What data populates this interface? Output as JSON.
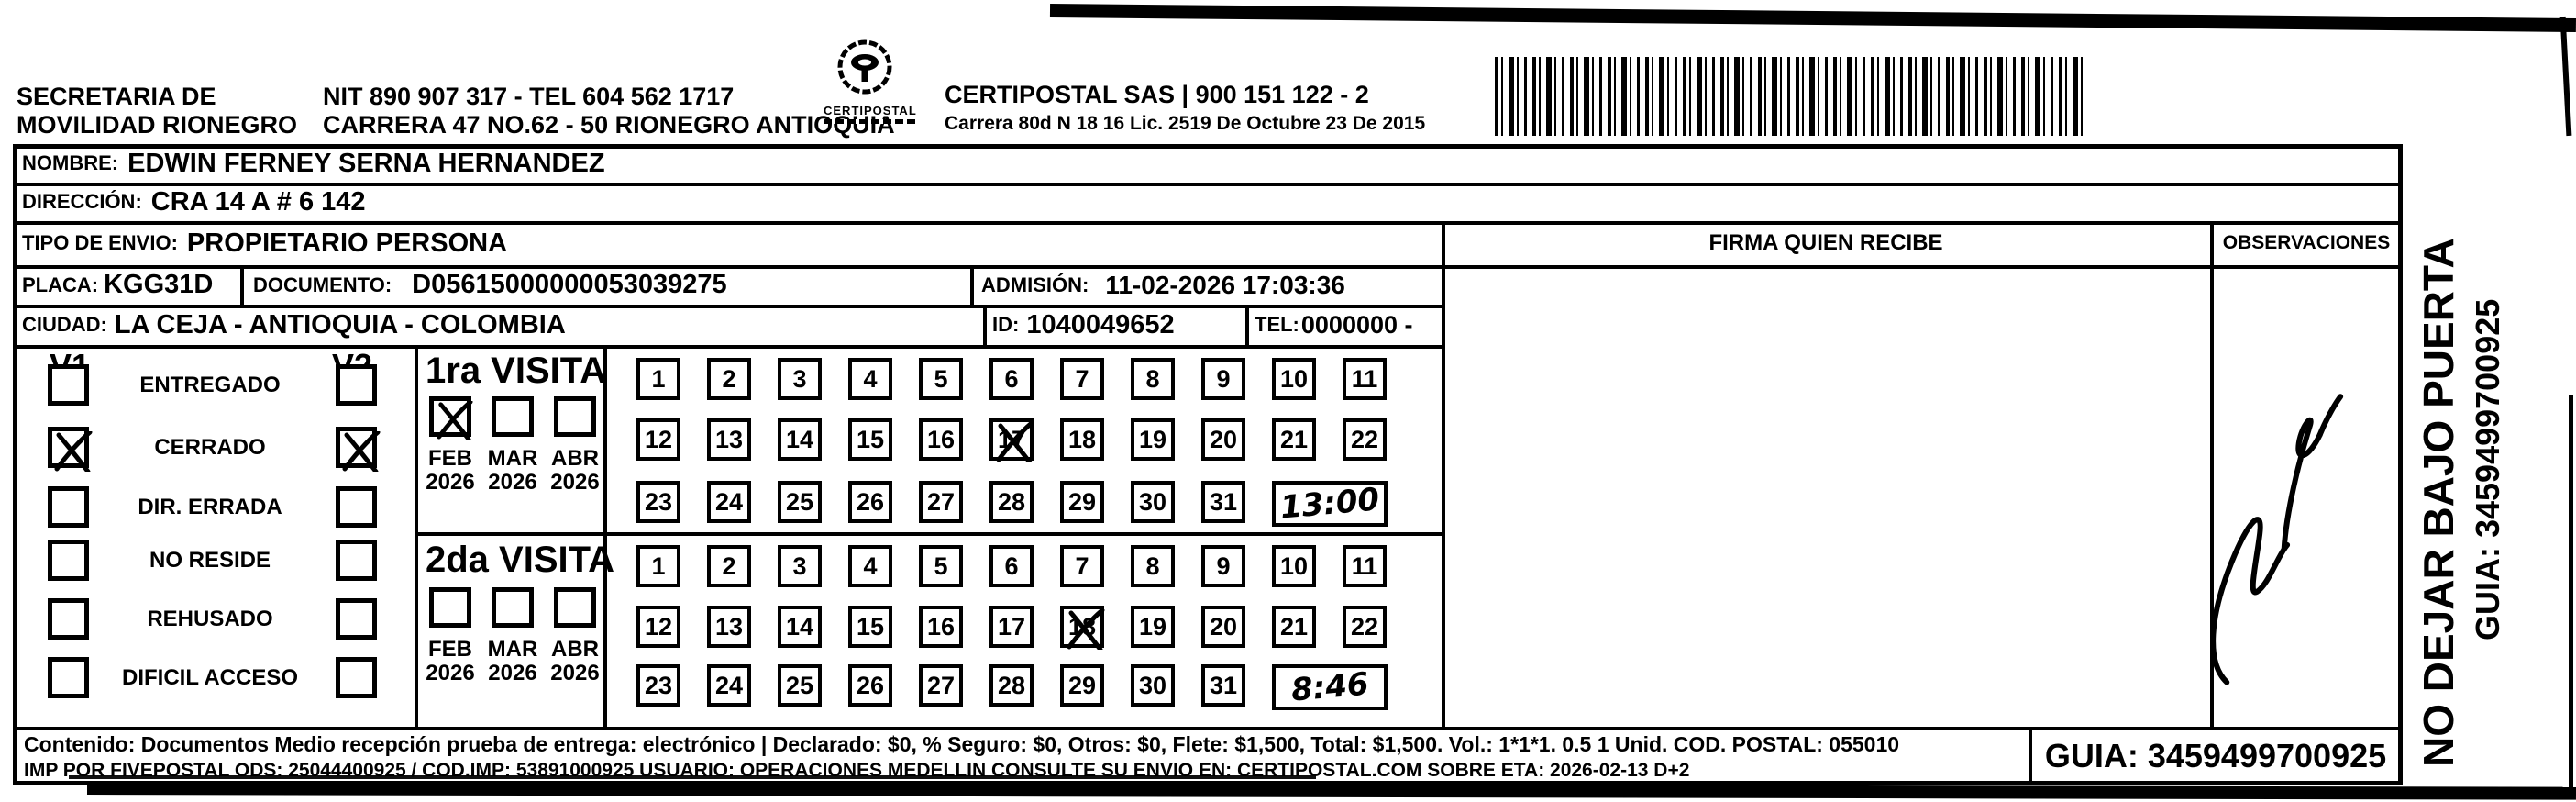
{
  "header": {
    "left_line1": "SECRETARIA  DE",
    "left_line2": "MOVILIDAD RIONEGRO",
    "center_line1": "NIT 890 907 317 - TEL 604 562 1717",
    "center_line2": "CARRERA 47 NO.62 - 50 RIONEGRO ANTIOQUIA",
    "logo_text": "CERTIPOSTAL",
    "right_line1": "CERTIPOSTAL SAS | 900 151 122 - 2",
    "right_line2": "Carrera 80d N 18 16  Lic. 2519 De Octubre 23 De 2015"
  },
  "recipient": {
    "nombre_label": "NOMBRE:",
    "nombre": "EDWIN FERNEY SERNA HERNANDEZ",
    "direccion_label": "DIRECCIÓN:",
    "direccion": "CRA 14 A # 6 142",
    "tipo_label": "TIPO DE ENVIO:",
    "tipo": "PROPIETARIO PERSONA",
    "placa_label": "PLACA:",
    "placa": "KGG31D",
    "documento_label": "DOCUMENTO:",
    "documento": "D05615000000053039275",
    "admision_label": "ADMISIÓN:",
    "admision": "11-02-2026 17:03:36",
    "ciudad_label": "CIUDAD:",
    "ciudad": "LA CEJA - ANTIOQUIA - COLOMBIA",
    "id_label": "ID:",
    "id": "1040049652",
    "tel_label": "TEL:",
    "tel": "0000000 -"
  },
  "firma_header": "FIRMA QUIEN RECIBE",
  "observaciones_header": "OBSERVACIONES",
  "status": {
    "v1_header": "V1",
    "v2_header": "V2",
    "rows": [
      {
        "label": "ENTREGADO",
        "v1": false,
        "v2": false
      },
      {
        "label": "CERRADO",
        "v1": true,
        "v2": true
      },
      {
        "label": "DIR. ERRADA",
        "v1": false,
        "v2": false
      },
      {
        "label": "NO RESIDE",
        "v1": false,
        "v2": false
      },
      {
        "label": "REHUSADO",
        "v1": false,
        "v2": false
      },
      {
        "label": "DIFICIL ACCESO",
        "v1": false,
        "v2": false
      }
    ]
  },
  "calendar_rows": [
    [
      1,
      2,
      3,
      4,
      5,
      6,
      7,
      8,
      9,
      10,
      11
    ],
    [
      12,
      13,
      14,
      15,
      16,
      17,
      18,
      19,
      20,
      21,
      22
    ],
    [
      23,
      24,
      25,
      26,
      27,
      28,
      29,
      30,
      31
    ]
  ],
  "visits": [
    {
      "title": "1ra VISITA",
      "months": [
        {
          "label": "FEB",
          "year": "2026",
          "checked": true
        },
        {
          "label": "MAR",
          "year": "2026",
          "checked": false
        },
        {
          "label": "ABR",
          "year": "2026",
          "checked": false
        }
      ],
      "marked_day": 17,
      "time_note": "13:00"
    },
    {
      "title": "2da VISITA",
      "months": [
        {
          "label": "FEB",
          "year": "2026",
          "checked": false
        },
        {
          "label": "MAR",
          "year": "2026",
          "checked": false
        },
        {
          "label": "ABR",
          "year": "2026",
          "checked": false
        }
      ],
      "marked_day": 18,
      "time_note": "8:46"
    }
  ],
  "footer": {
    "line1": "Contenido: Documentos Medio recepción prueba de entrega: electrónico | Declarado: $0, % Seguro: $0, Otros: $0, Flete: $1,500, Total: $1,500. Vol.: 1*1*1. 0.5  1 Unid. COD. POSTAL: 055010",
    "line2": "IMP POR FIVEPOSTAL ODS: 25044400925 / COD.IMP: 53891000925 USUARIO: OPERACIONES MEDELLIN CONSULTE SU ENVIO EN: CERTIPOSTAL.COM SOBRE ETA: 2026-02-13 D+2",
    "guia": "GUIA: 3459499700925"
  },
  "side_note": {
    "line1": "NO DEJAR BAJO PUERTA",
    "line2": "GUIA: 3459499700925"
  },
  "colors": {
    "ink": "#000000",
    "paper": "#ffffff"
  }
}
